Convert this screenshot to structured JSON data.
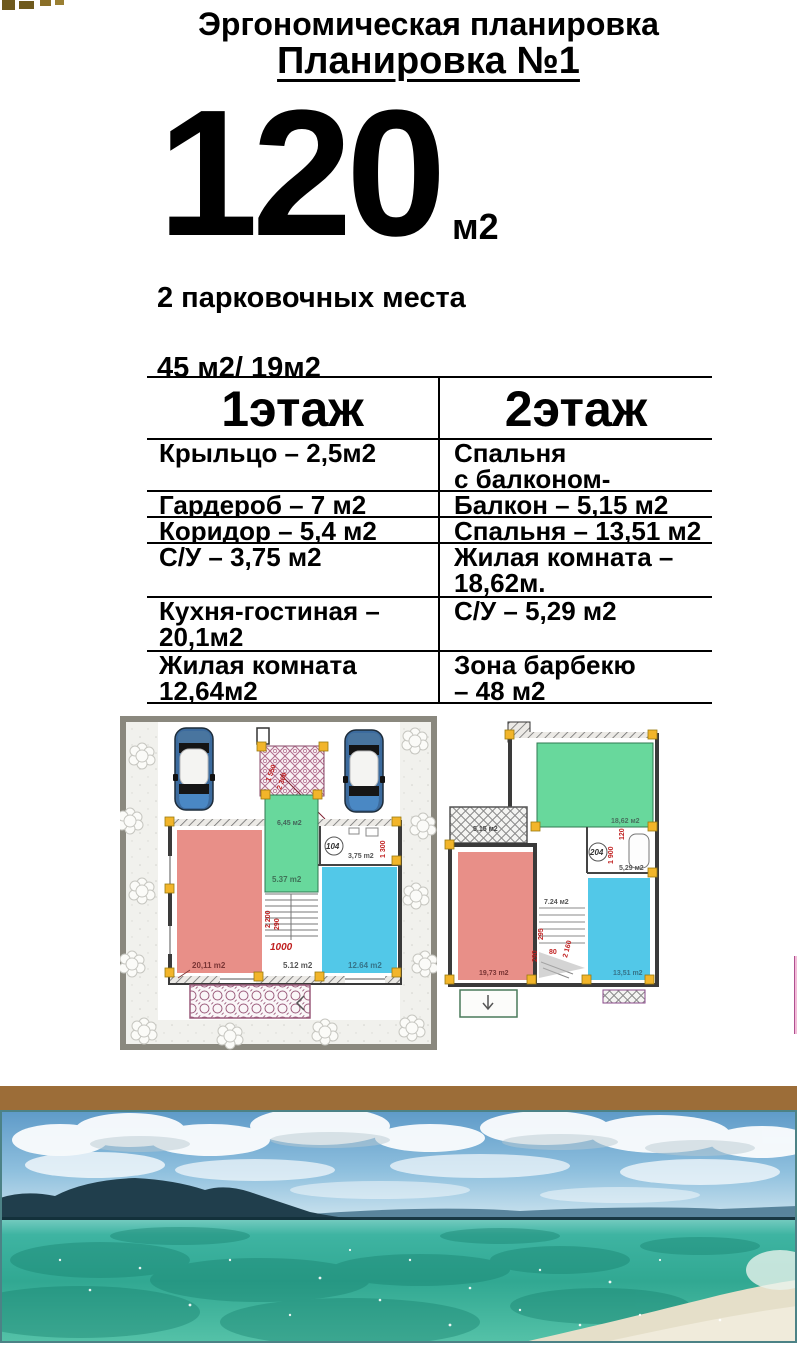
{
  "header": {
    "title": "Эргономическая планировка",
    "subtitle": "Планировка №1"
  },
  "area": {
    "value": "120",
    "unit": "м2"
  },
  "parking": {
    "line1": "2 парковочных места",
    "line2": "45 м2/ 19м2"
  },
  "floors_table": {
    "headers": [
      "1этаж",
      "2этаж"
    ],
    "rows": [
      {
        "c1": "Крыльцо – 2,5м2",
        "c2": "Спальня\nс балконом- 19,73м2"
      },
      {
        "c1": "Гардероб – 7 м2",
        "c2": "Балкон – 5,15 м2"
      },
      {
        "c1": "Коридор – 5,4 м2",
        "c2": "Спальня – 13,51 м2"
      },
      {
        "c1": "С/У – 3,75 м2",
        "c2": "Жилая комната –\n18,62м."
      },
      {
        "c1": "Кухня-гостиная –\n20,1м2",
        "c2": "С/У – 5,29 м2"
      },
      {
        "c1": "Жилая комната\n12,64м2",
        "c2": "Зона барбекю\n – 48 м2"
      }
    ]
  },
  "plan1": {
    "kitchen_living": "20,11 m2",
    "hall": "5.12 m2",
    "living": "12.64 m2",
    "wardrobe_top": "6,45 м2",
    "wardrobe": "5.37 m2",
    "wc_num": "104",
    "wc": "3,75 m2",
    "stair_dim": "1000",
    "dim1": "1 550",
    "dim2": "2 300",
    "dim3": "1 300",
    "dim4": "2 200",
    "dim5": "290"
  },
  "plan2": {
    "bedroom_green": "18,62 м2",
    "balcony": "5,15 м2",
    "bedroom_red": "19,73 m2",
    "bedroom_blue": "13,51 m2",
    "wc_num": "204",
    "wc": "5,29 м2",
    "stairs": "7.24 м2",
    "dim1": "1 900",
    "dim2": "120",
    "dim3": "295",
    "dim4": "290",
    "dim5": "80",
    "dim6": "2 160"
  },
  "colors": {
    "room_red": "#e88f88",
    "room_green": "#68d89c",
    "room_blue": "#52c8e8",
    "corner_marker": "#f2b52a",
    "divider_brown": "#9c6d38",
    "sea_turquoise": "#3fb3a0"
  }
}
